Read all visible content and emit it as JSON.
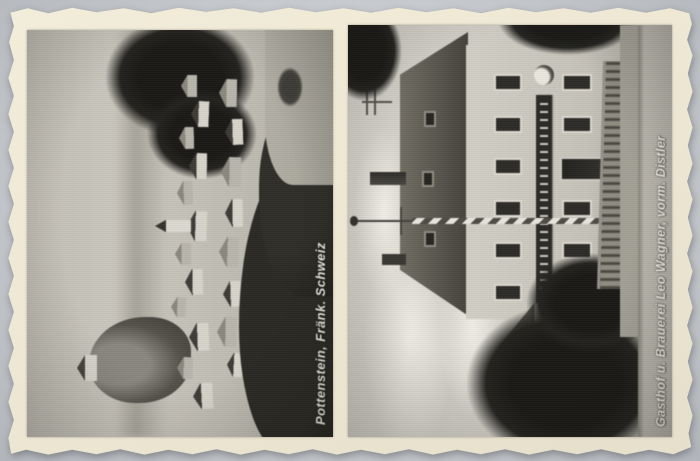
{
  "postcard": {
    "left_photo": {
      "caption": "Pottenstein, Fränk. Schweiz"
    },
    "right_photo": {
      "caption": "Gasthof u. Brauerei Leo Wagner, vorm. Distler"
    },
    "colors": {
      "scan_background": "#c8cbcf",
      "card_paper": "#ece6d2",
      "photo_highlight": "#d4d1c9",
      "photo_shadow": "#1d1c19",
      "caption_text": "#f3f0e7"
    }
  }
}
